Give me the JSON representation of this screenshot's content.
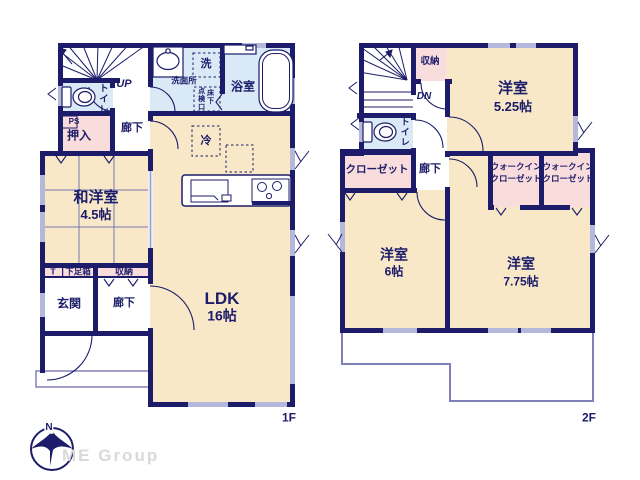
{
  "floor1": {
    "floor_label": "1F",
    "rooms": {
      "washitsu": {
        "name": "和洋室",
        "size": "4.5帖"
      },
      "ldk": {
        "name": "LDK",
        "size": "16帖"
      },
      "bath": {
        "name": "浴室"
      },
      "washroom": {
        "name": "洗面所"
      },
      "toilet": {
        "name": "トイレ"
      },
      "oshiire": {
        "name": "押入"
      },
      "genkan": {
        "name": "玄関"
      },
      "hall_upper": {
        "name": "廊下"
      },
      "hall_lower": {
        "name": "廊下"
      },
      "storage": {
        "name": "収納"
      },
      "shoebox": {
        "name": "下足箱"
      },
      "t": {
        "name": "T"
      }
    },
    "annotations": {
      "up": "UP",
      "ps": "PS",
      "laundry": "洗",
      "inspection": "点検口",
      "underfloor": "床下",
      "fridge": "冷"
    }
  },
  "floor2": {
    "floor_label": "2F",
    "rooms": {
      "bed525": {
        "name": "洋室",
        "size": "5.25帖"
      },
      "bed6": {
        "name": "洋室",
        "size": "6帖"
      },
      "bed775": {
        "name": "洋室",
        "size": "7.75帖"
      },
      "storage": {
        "name": "収納"
      },
      "toilet": {
        "name": "トイレ"
      },
      "closet": {
        "name": "クローゼット"
      },
      "wic1": {
        "line1": "ウォークイン",
        "line2": "クローゼット"
      },
      "wic2": {
        "line1": "ウォークイン",
        "line2": "クローゼット"
      },
      "hall": {
        "name": "廊下"
      }
    },
    "annotations": {
      "dn": "DN"
    }
  },
  "footer": {
    "brand": "ME Group",
    "compass_north": "N"
  },
  "colors": {
    "wall": "#1c1c6a",
    "room_cream": "#f8e8c8",
    "room_pink": "#f9dcdc",
    "room_blue": "#d9e9f6",
    "window": "#b4b9dc",
    "outline_thin": "#8080b8"
  }
}
